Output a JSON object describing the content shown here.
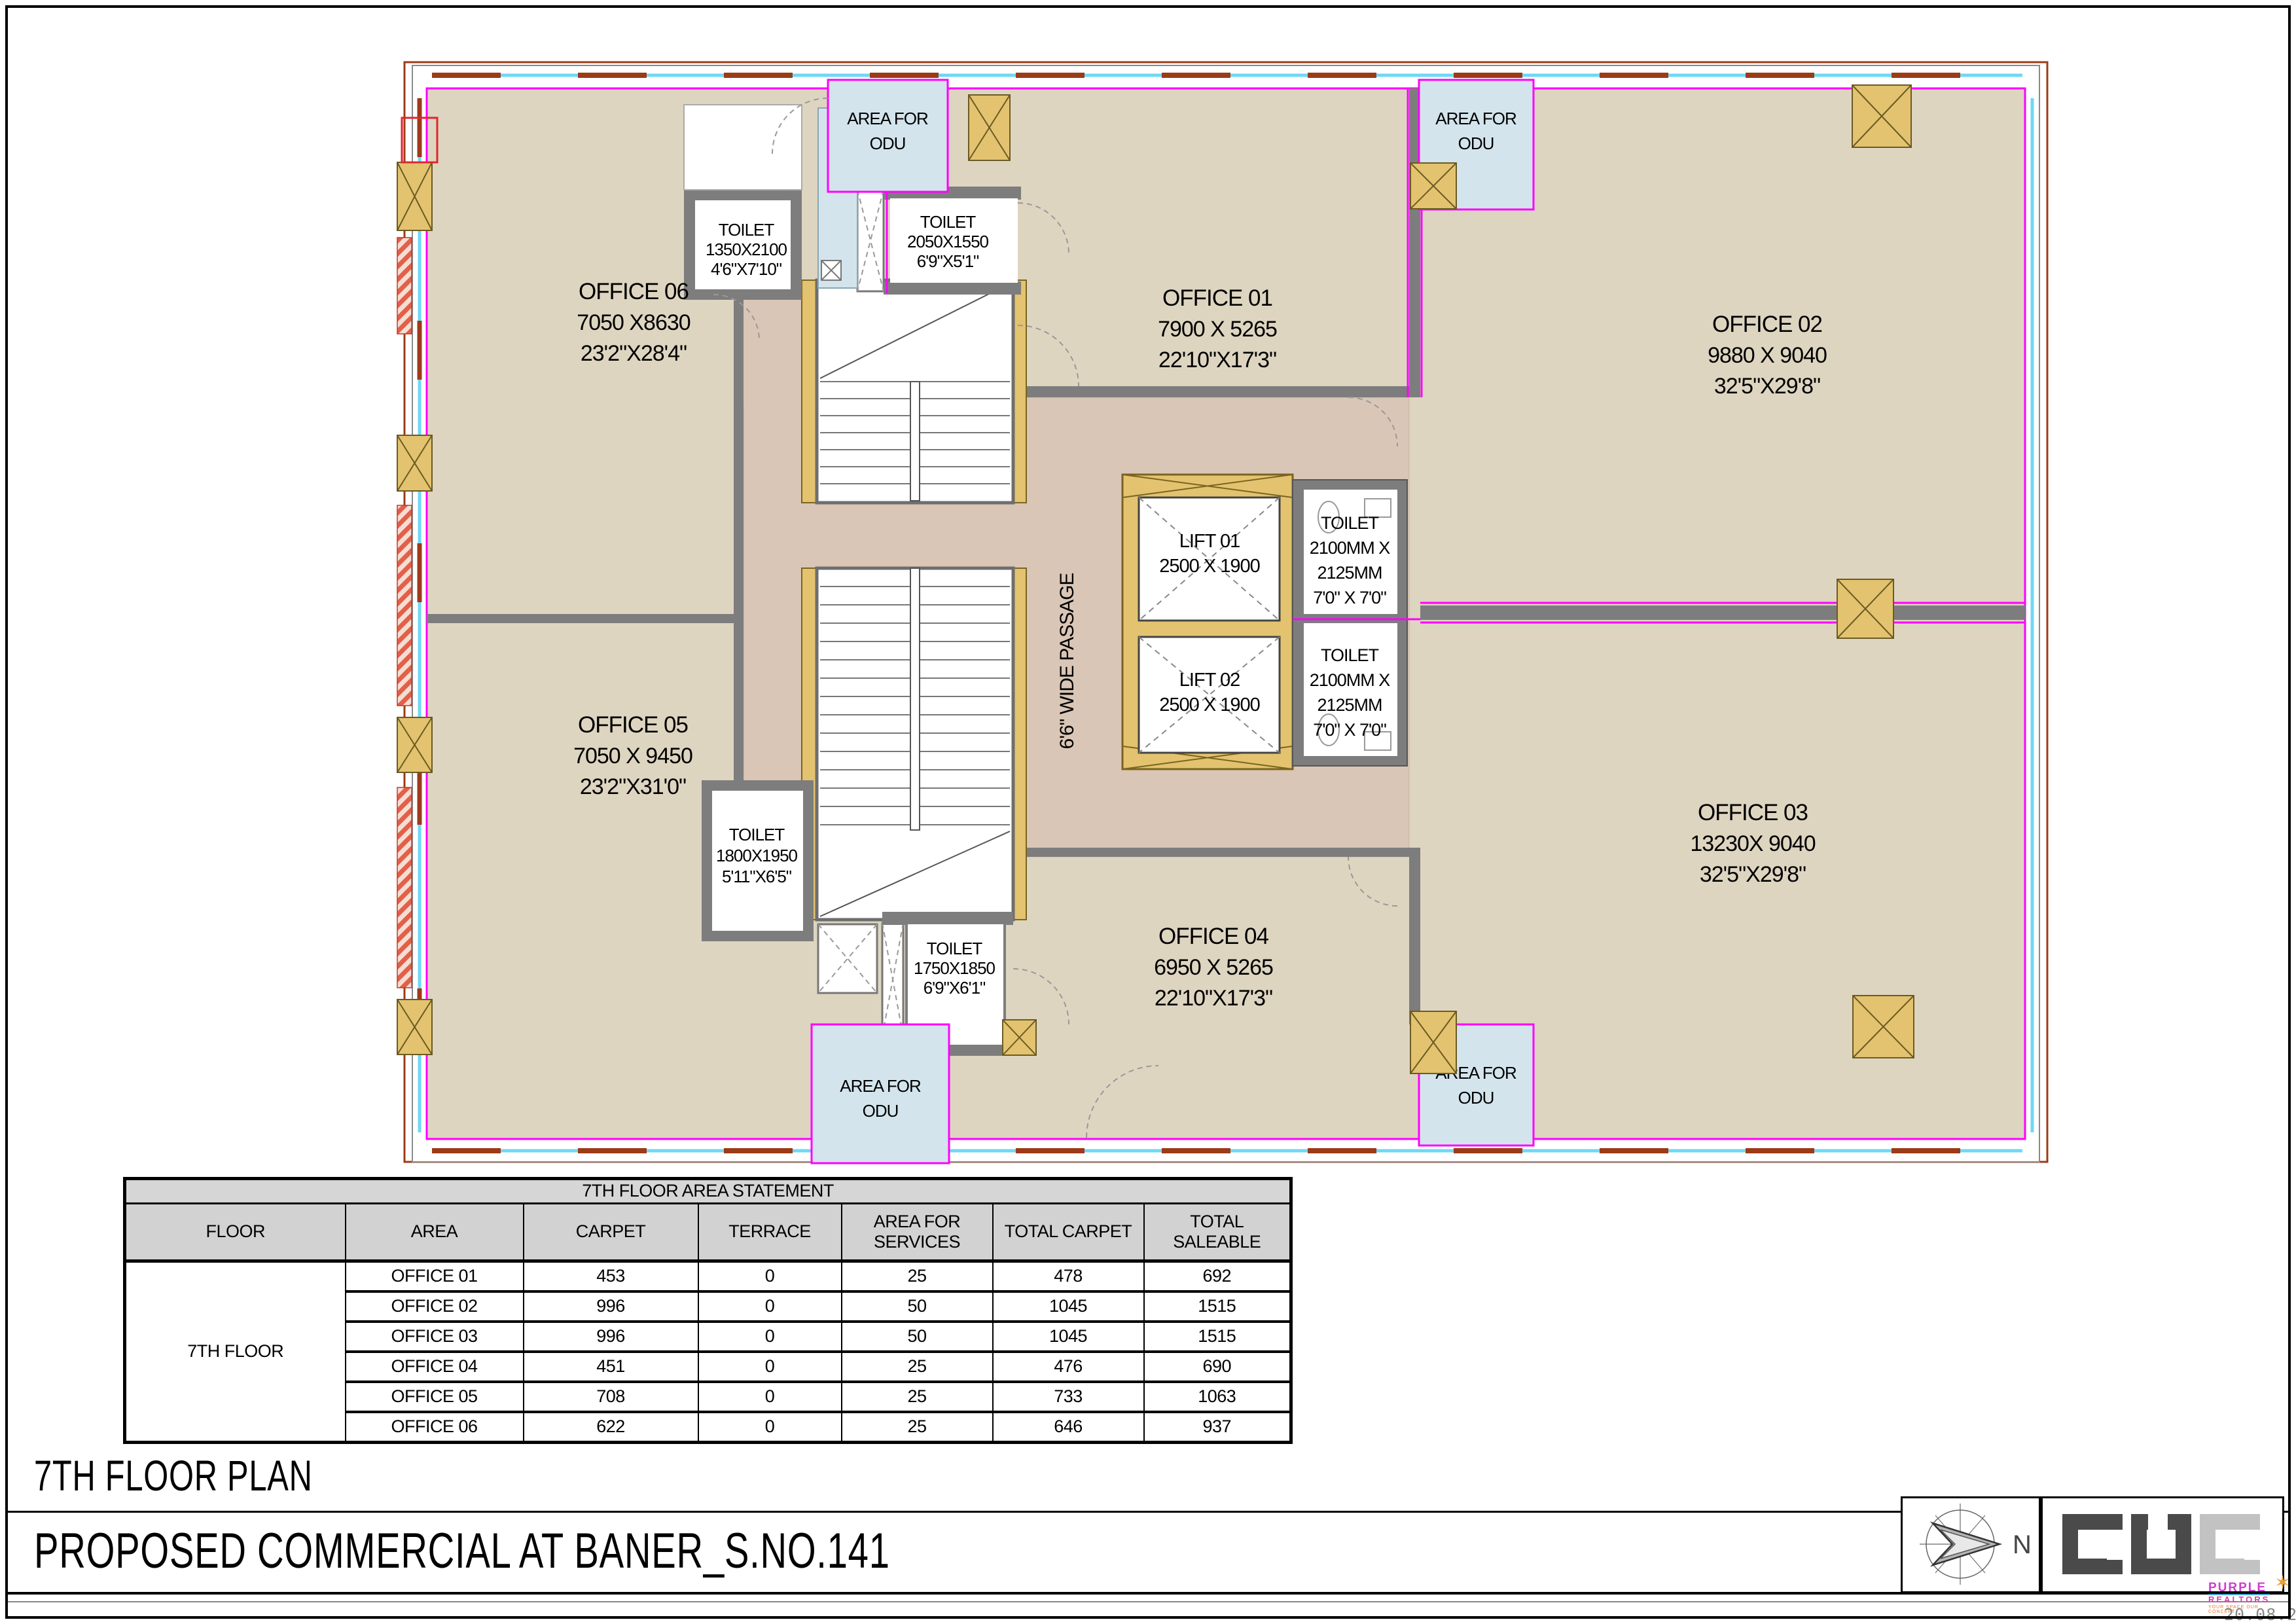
{
  "sheet": {
    "date": "20.08.2025"
  },
  "titles": {
    "plan_title": "7TH FLOOR PLAN",
    "project_title": "PROPOSED  COMMERCIAL AT BANER_S.NO.141",
    "north_label": "N"
  },
  "purple_logo": {
    "line1": "PURPLE",
    "line2": "REALTORS",
    "line3": "YOUR SPACE OUR CONCEPT"
  },
  "table": {
    "title": "7TH FLOOR AREA STATEMENT",
    "headers": [
      "FLOOR",
      "AREA",
      "CARPET",
      "TERRACE",
      "AREA FOR SERVICES",
      "TOTAL CARPET",
      "TOTAL SALEABLE"
    ],
    "floor_label": "7TH FLOOR",
    "rows": [
      {
        "area": "OFFICE 01",
        "carpet": "453",
        "terrace": "0",
        "services": "25",
        "total_carpet": "478",
        "total_saleable": "692"
      },
      {
        "area": "OFFICE 02",
        "carpet": "996",
        "terrace": "0",
        "services": "50",
        "total_carpet": "1045",
        "total_saleable": "1515"
      },
      {
        "area": "OFFICE 03",
        "carpet": "996",
        "terrace": "0",
        "services": "50",
        "total_carpet": "1045",
        "total_saleable": "1515"
      },
      {
        "area": "OFFICE 04",
        "carpet": "451",
        "terrace": "0",
        "services": "25",
        "total_carpet": "476",
        "total_saleable": "690"
      },
      {
        "area": "OFFICE 05",
        "carpet": "708",
        "terrace": "0",
        "services": "25",
        "total_carpet": "733",
        "total_saleable": "1063"
      },
      {
        "area": "OFFICE 06",
        "carpet": "622",
        "terrace": "0",
        "services": "25",
        "total_carpet": "646",
        "total_saleable": "937"
      }
    ]
  },
  "plan": {
    "offices": {
      "o01": {
        "name": "OFFICE 01",
        "mm": "7900 X 5265",
        "ft": "22'10\"X17'3\""
      },
      "o02": {
        "name": "OFFICE 02",
        "mm": "9880 X 9040",
        "ft": "32'5\"X29'8\""
      },
      "o03": {
        "name": "OFFICE 03",
        "mm": "13230X 9040",
        "ft": "32'5\"X29'8\""
      },
      "o04": {
        "name": "OFFICE 04",
        "mm": "6950 X 5265",
        "ft": "22'10\"X17'3\""
      },
      "o05": {
        "name": "OFFICE 05",
        "mm": "7050 X 9450",
        "ft": "23'2\"X31'0\""
      },
      "o06": {
        "name": "OFFICE 06",
        "mm": "7050 X8630",
        "ft": "23'2\"X28'4\""
      }
    },
    "toilets": {
      "t1350": {
        "l1": "TOILET",
        "l2": "1350X2100",
        "l3": "4'6\"X7'10\""
      },
      "t2050": {
        "l1": "TOILET",
        "l2": "2050X1550",
        "l3": "6'9\"X5'1\""
      },
      "t1800": {
        "l1": "TOILET",
        "l2": "1800X1950",
        "l3": "5'11\"X6'5\""
      },
      "t1750": {
        "l1": "TOILET",
        "l2": "1750X1850",
        "l3": "6'9\"X6'1\""
      },
      "lift_wc": {
        "l1": "TOILET",
        "l2": "2100MM X",
        "l3": "2125MM",
        "l4": "7'0\" X 7'0\""
      }
    },
    "lifts": {
      "lift1": {
        "name": "LIFT 01",
        "dim": "2500 X 1900"
      },
      "lift2": {
        "name": "LIFT 02",
        "dim": "2500 X 1900"
      }
    },
    "passage": "6'6\" WIDE PASSAGE",
    "odu": {
      "l1": "AREA FOR",
      "l2": "ODU"
    }
  },
  "colors": {
    "office_floor": "#ded5c1",
    "core_floor": "#d9c6b6",
    "wall_gray": "#7d7d7d",
    "column_tan": "#e3c36f",
    "magenta": "#ff00ff",
    "glass_cyan": "#6fd8f4",
    "mullion_brown": "#9c3b17",
    "odu_blue": "#d3e4ec"
  }
}
